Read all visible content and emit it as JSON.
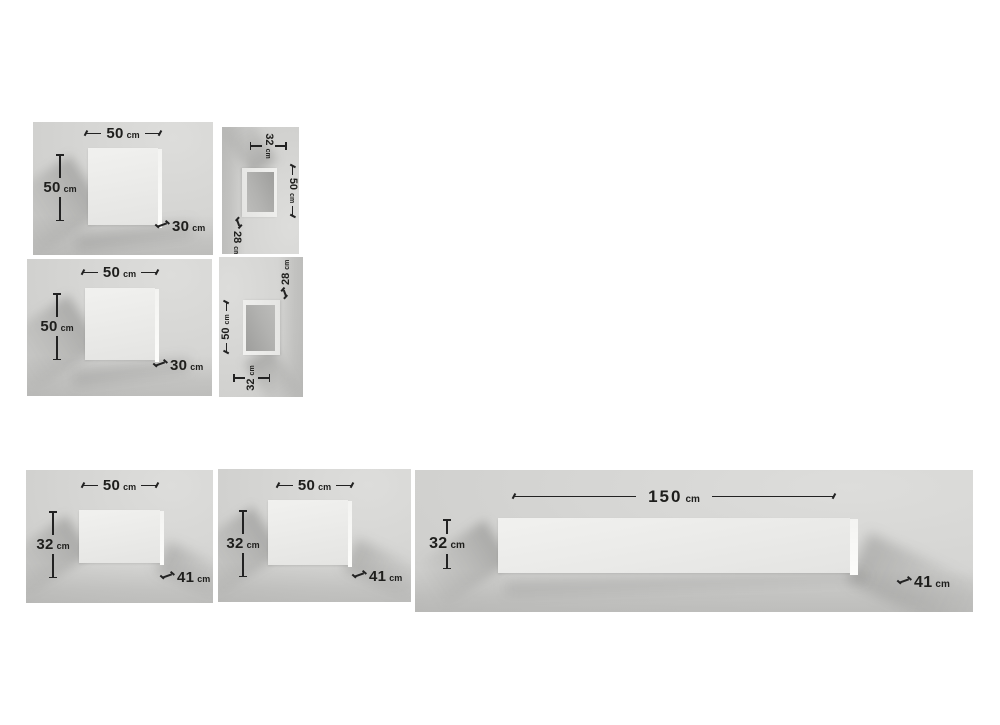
{
  "page": {
    "background": "#ffffff"
  },
  "colors": {
    "photo_background": "#d4d4d2",
    "box_face": "#eeeeec",
    "box_interior": "#a8a8a6",
    "dimension_text": "#1e1e1c"
  },
  "panels": {
    "p1": {
      "name": "wall cube front view 1",
      "width": {
        "value": "50",
        "unit": "cm"
      },
      "height": {
        "value": "50",
        "unit": "cm"
      },
      "depth": {
        "value": "30",
        "unit": "cm"
      }
    },
    "p2": {
      "name": "open box side view rotated clockwise",
      "width": {
        "value": "50",
        "unit": "cm"
      },
      "height": {
        "value": "32",
        "unit": "cm"
      },
      "depth": {
        "value": "28",
        "unit": "cm"
      }
    },
    "p3": {
      "name": "wall cube front view 2",
      "width": {
        "value": "50",
        "unit": "cm"
      },
      "height": {
        "value": "50",
        "unit": "cm"
      },
      "depth": {
        "value": "30",
        "unit": "cm"
      }
    },
    "p4": {
      "name": "open box side view rotated counterclockwise",
      "width": {
        "value": "50",
        "unit": "cm"
      },
      "height": {
        "value": "32",
        "unit": "cm"
      },
      "depth": {
        "value": "28",
        "unit": "cm"
      }
    },
    "p5": {
      "name": "wall shelf front view 1",
      "width": {
        "value": "50",
        "unit": "cm"
      },
      "height": {
        "value": "32",
        "unit": "cm"
      },
      "depth": {
        "value": "41",
        "unit": "cm"
      }
    },
    "p6": {
      "name": "wall shelf front view 2",
      "width": {
        "value": "50",
        "unit": "cm"
      },
      "height": {
        "value": "32",
        "unit": "cm"
      },
      "depth": {
        "value": "41",
        "unit": "cm"
      }
    },
    "p7": {
      "name": "wall shelf front view long",
      "width": {
        "value": "150",
        "unit": "cm"
      },
      "height": {
        "value": "32",
        "unit": "cm"
      },
      "depth": {
        "value": "41",
        "unit": "cm"
      }
    }
  }
}
